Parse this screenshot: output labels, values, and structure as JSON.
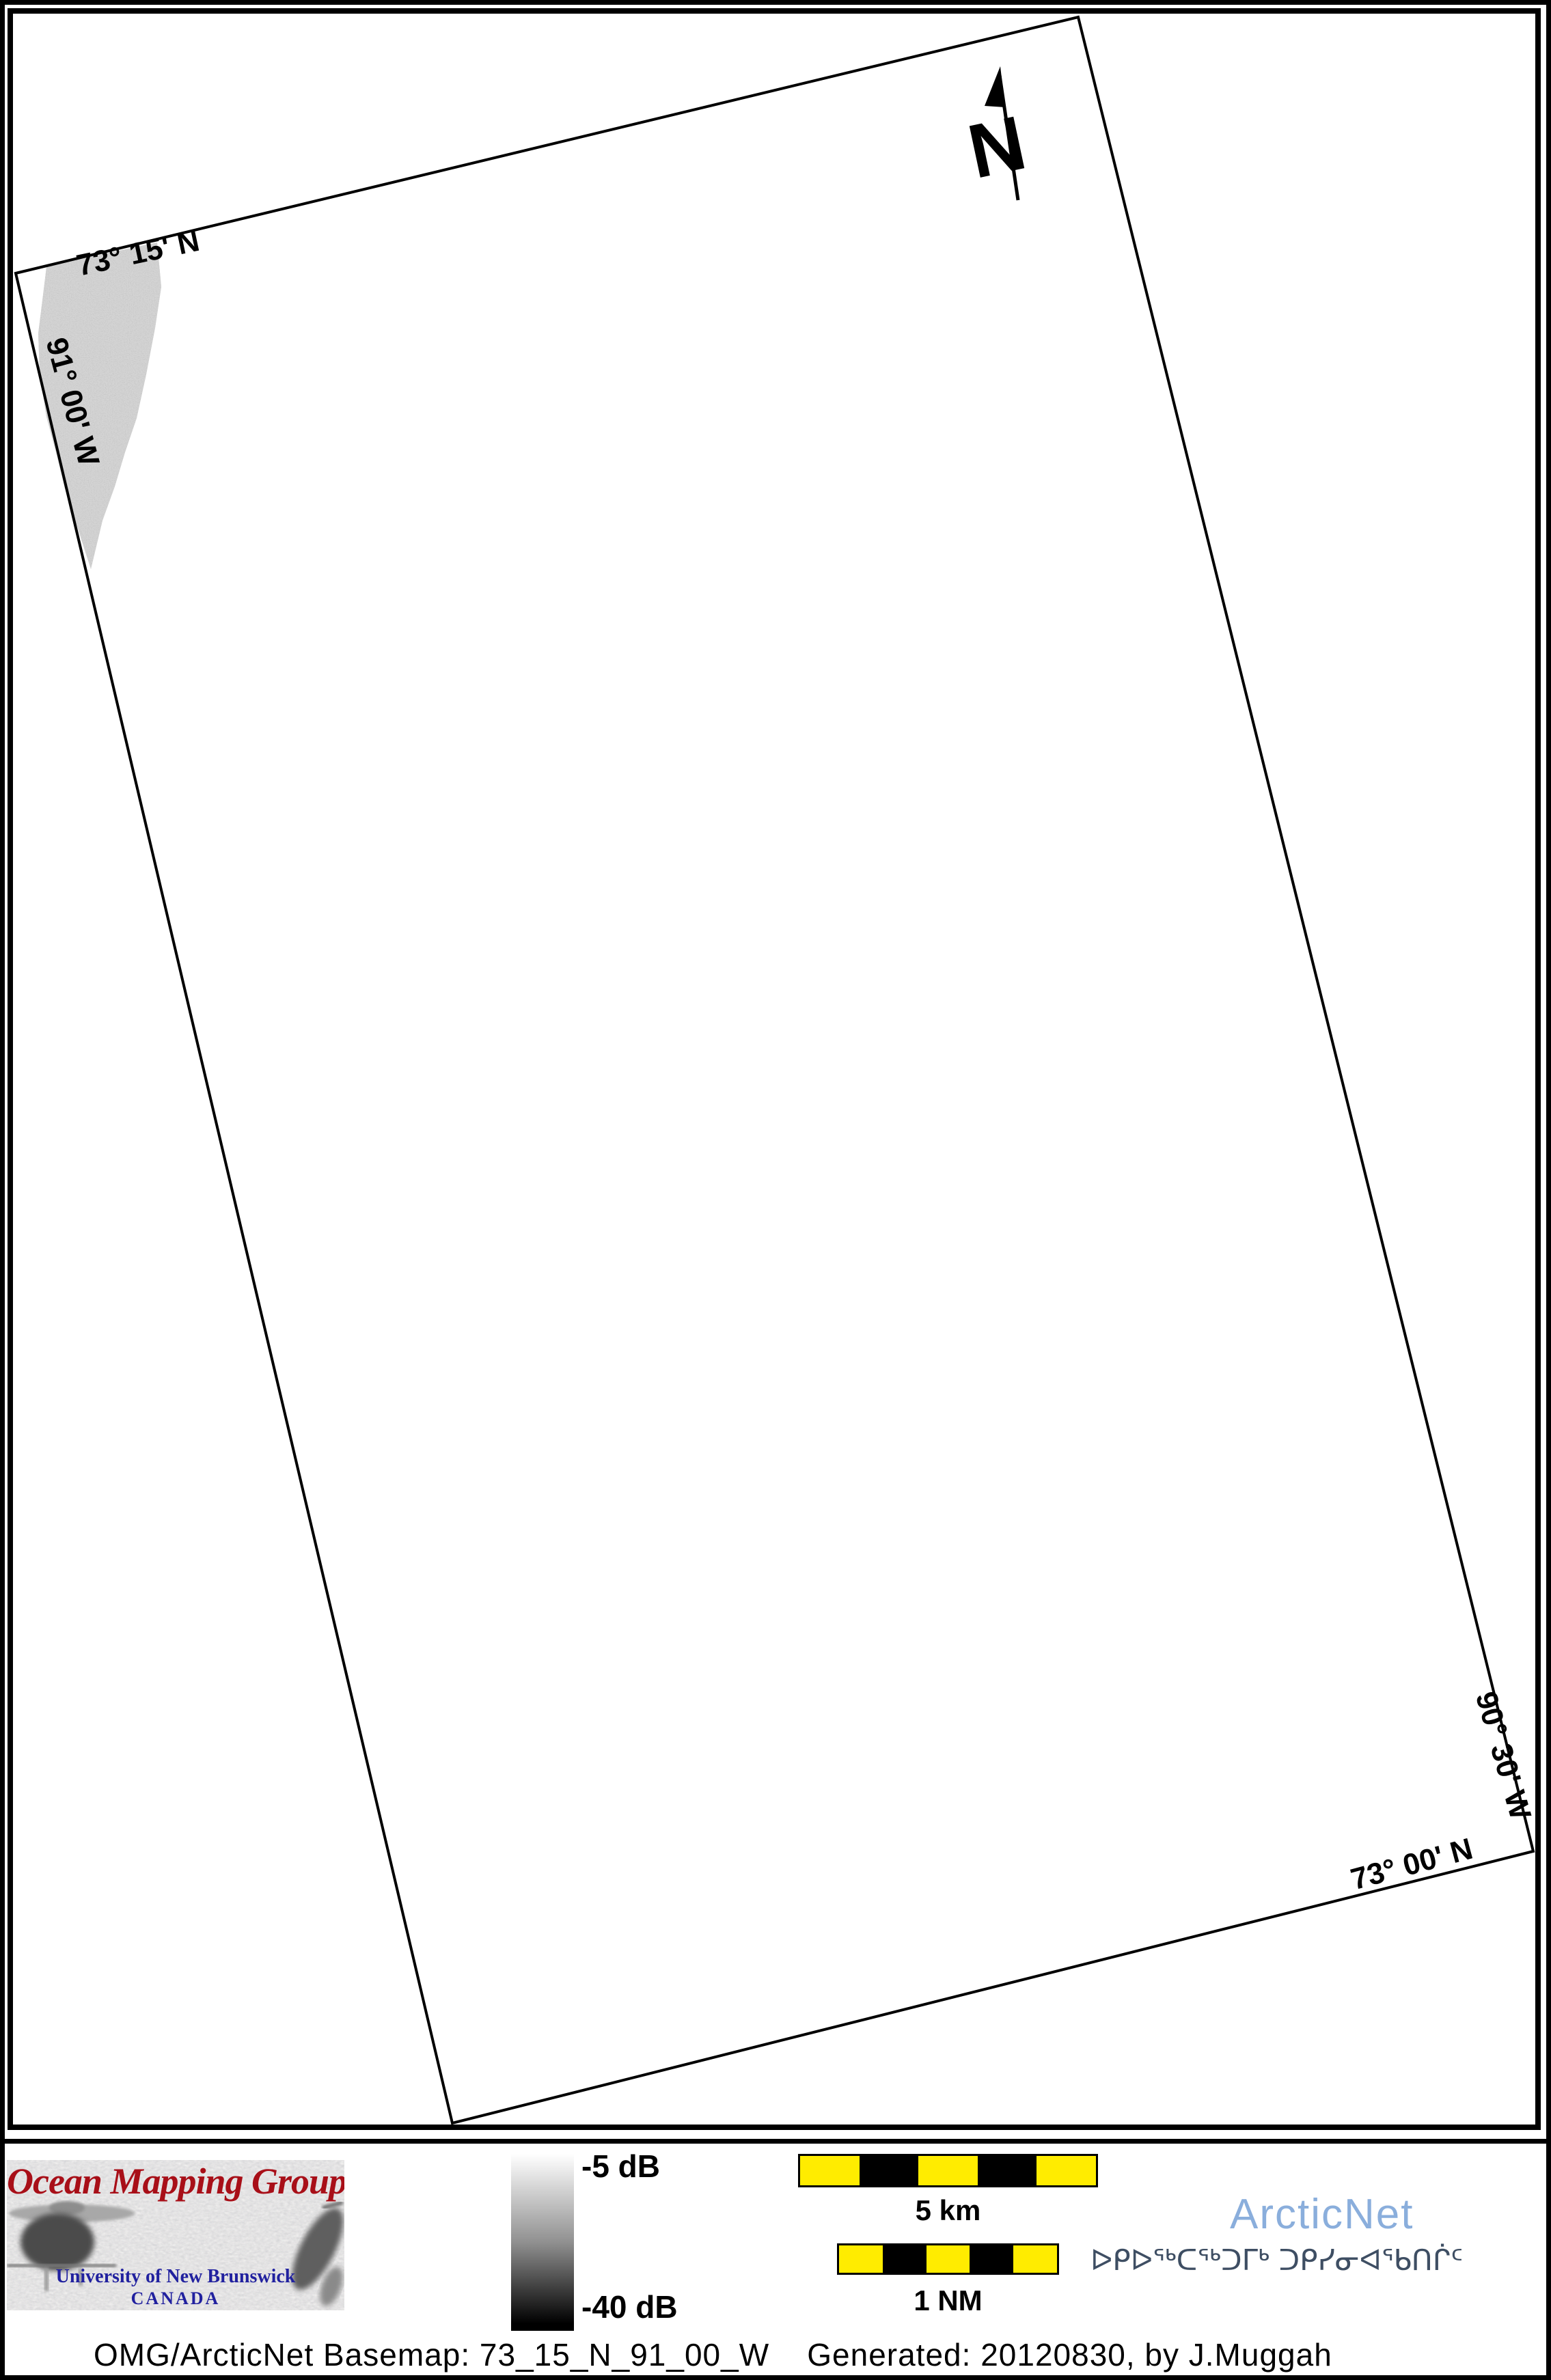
{
  "map": {
    "graticule_labels": {
      "top_latitude": "73° 15' N",
      "left_longitude": "91° 00' W",
      "right_longitude": "90° 30' W",
      "bottom_latitude": "73° 00' N"
    },
    "north_arrow_label": "N"
  },
  "legend": {
    "omg_logo": {
      "title": "Ocean Mapping Group",
      "university": "University of New Brunswick",
      "country": "CANADA"
    },
    "colorbar": {
      "top_label": "-5 dB",
      "bottom_label": "-40 dB"
    },
    "scale_bars": {
      "km_label": "5 km",
      "nm_label": "1 NM"
    },
    "arcticnet": {
      "name": "ArcticNet",
      "inuktitut_name": "ᐅᑭᐅᖅᑕᖅᑐᒥᒃ ᑐᑭᓯᓂᐊᖃᑎᒌᑦ"
    },
    "caption": "OMG/ArcticNet Basemap: 73_15_N_91_00_W    Generated: 20120830, by J.Muggah"
  },
  "colors": {
    "omg_red": "#A80F18",
    "unb_blue": "#21219F",
    "arcticnet_blue": "#8AAEDC",
    "inuktitut_blue": "#3E4E63",
    "scalebar_yellow": "#FFEC00",
    "swath_gray": "#C2C2C2"
  }
}
